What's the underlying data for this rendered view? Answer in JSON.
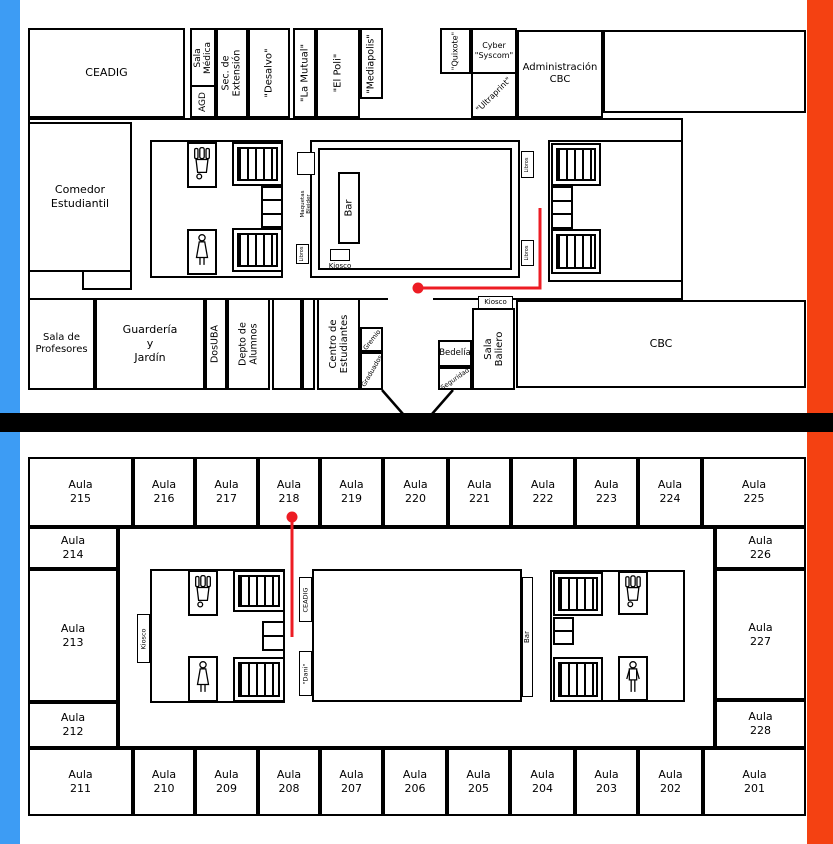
{
  "colors": {
    "left_band": "#3D9CF4",
    "right_band": "#F44112",
    "divider": "#000000",
    "marker_red": "#ED1C24"
  },
  "icons": {
    "stairs": "stairs-icon",
    "elevator": "elevator-icon",
    "male": "male-wc-icon",
    "female": "female-wc-icon",
    "figure": "person-wc-icon",
    "marker": "location-dot-icon"
  },
  "upper": {
    "ceadig": "CEADIG",
    "sala_medica": [
      "Sala",
      "Médica"
    ],
    "agd": "AGD",
    "sec_extension": [
      "Sec. de",
      "Extensión"
    ],
    "desalvo": "\"Desalvo\"",
    "la_mutual": "\"La Mutual\"",
    "el_poli": "\"El Poli\"",
    "mediapolis": "\"Mediapolis\"",
    "quixote": "\"Quixote\"",
    "cyber_syscom": [
      "Cyber",
      "\"Syscom\""
    ],
    "ultraprint": "\"Ultraprint\"",
    "administracion_cbc": [
      "Administración",
      "CBC"
    ],
    "comedor": [
      "Comedor",
      "Estudiantil"
    ],
    "sala_profesores": [
      "Sala de",
      "Profesores"
    ],
    "guarderia": [
      "Guardería",
      "y",
      "Jardín"
    ],
    "dosuba": "DosUBA",
    "depto_alumnos": [
      "Depto de",
      "Alumnos"
    ],
    "centro_estudiantes": [
      "Centro de",
      "Estudiantes"
    ],
    "gremio": "Gremio",
    "graduados": "Graduados",
    "bedelia": "Bedelía",
    "seguridad": "Seguridad",
    "sala_baliero": [
      "Sala",
      "Baliero"
    ],
    "kiosco_cbc": "Kiosco",
    "cbc": "CBC",
    "bar": "Bar",
    "kiosco_patio": "Kiosco",
    "maquetas": [
      "Maquetas",
      "Blejder"
    ],
    "libros": "Libros"
  },
  "lower": {
    "aula_word": "Aula",
    "top_row": [
      "215",
      "216",
      "217",
      "218",
      "219",
      "220",
      "221",
      "222",
      "223",
      "224",
      "225"
    ],
    "left_col": [
      "214",
      "213",
      "212"
    ],
    "right_col": [
      "226",
      "227",
      "228"
    ],
    "bottom_row": [
      "211",
      "210",
      "209",
      "208",
      "207",
      "206",
      "205",
      "204",
      "203",
      "202",
      "201"
    ],
    "kiosco": "Kiosco",
    "ceadig": "CEADIG",
    "dani": "\"Dani\"",
    "bar": "Bar"
  }
}
